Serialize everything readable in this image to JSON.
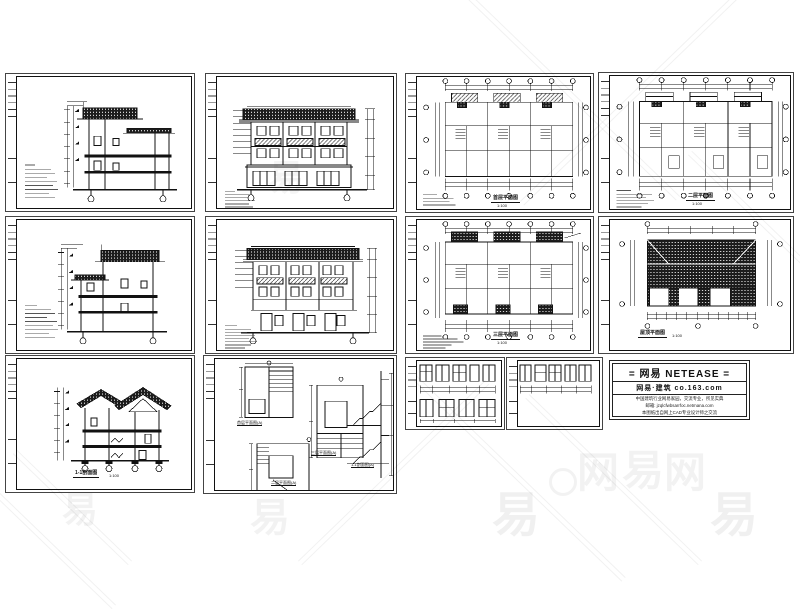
{
  "page": {
    "background_hex": "#ffffff",
    "line_hex": "#111111"
  },
  "watermark": {
    "glyph_a": "易",
    "glyph_b": "网",
    "brand_row": [
      "网",
      "易",
      "网"
    ],
    "color_hex": "#e8e8e8"
  },
  "panels": {
    "p1": {
      "name": "side-elevation-a"
    },
    "p2": {
      "name": "front-elevation"
    },
    "p3": {
      "title": "首层平面图",
      "scale": "1:100"
    },
    "p4": {
      "title": "二层平面图",
      "scale": "1:100"
    },
    "p5": {
      "name": "side-elevation-b"
    },
    "p6": {
      "name": "rear-elevation"
    },
    "p7": {
      "title": "三层平面图",
      "scale": "1:100"
    },
    "p8": {
      "title": "屋顶平面图",
      "scale": "1:100"
    },
    "p9": {
      "title": "1-1剖面图",
      "scale": "1:100"
    },
    "p10": {
      "subtitles": [
        "首层平面图(A)",
        "二层平面图(A)",
        "三层平面图(A)",
        "1-1剖面图(A)"
      ]
    },
    "p11": {
      "name": "door-window-details-a"
    },
    "p12": {
      "name": "door-window-details-b"
    }
  },
  "title_block": {
    "brand": "= 网易 NETEASE =",
    "site": "网易·建筑  co.163.com",
    "line1": "中国建筑行业网易家园，交流专业，所见实典",
    "line2": "邮箱: jzqlcfwbsarrfoc.netmana.com",
    "line3": "本图纸出自网上CAD专业设计师之交流"
  }
}
